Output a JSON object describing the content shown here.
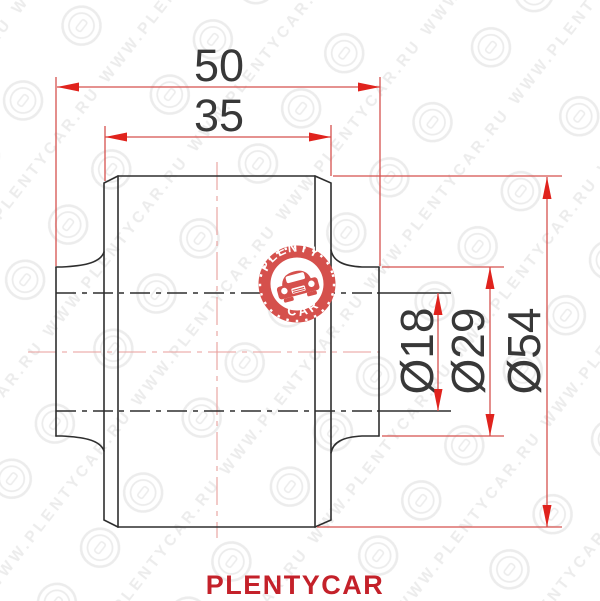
{
  "dimensions": {
    "total_length": "50",
    "body_length": "35",
    "bore_diameter": "Ø18",
    "sleeve_diameter": "Ø29",
    "outer_diameter": "Ø54"
  },
  "logo": {
    "arc_top": "PLENTY",
    "arc_bottom": "CAR"
  },
  "watermark": {
    "text": "WWW.PLENTYCAR.RU"
  },
  "footer": {
    "brand": "PLENTYCAR"
  },
  "colors": {
    "dimension_red": "#d5514e",
    "arrow_red": "#e0231d",
    "centerline_pink": "#e89e9b",
    "brand_red": "#c4212a",
    "logo_red": "#d5504c",
    "line_black": "#2e2e2e"
  }
}
